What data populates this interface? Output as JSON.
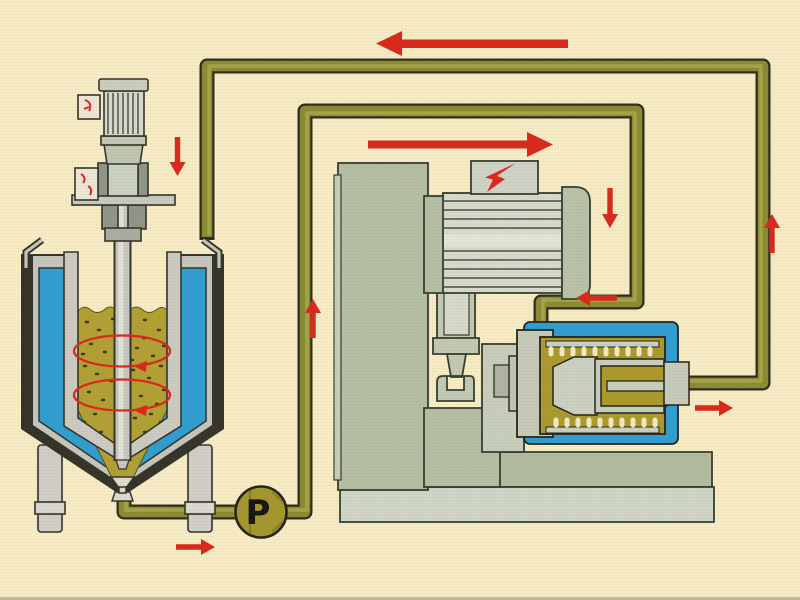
{
  "pump": {
    "label": "P"
  },
  "colors": {
    "background": "#f8edc7",
    "pipe": "#8b8b35",
    "pipe_highlight": "#a9a94e",
    "flow_arrow": "#da291c",
    "coolant_blue": "#2f9fd3",
    "product_olive": "#b1a134",
    "mill_product": "#ab9a2d",
    "pump_body": "#a4972f",
    "machine_green": "#b4bfa5",
    "metal_gray": "#c9cac3"
  },
  "components": {
    "tank": "jacketed-mixing-tank",
    "agitator": "agitator-motor-unit",
    "pump_name": "circulation-pump",
    "mill": "bead-mill-stand",
    "mill_motor": "mill-drive-motor",
    "chamber": "cooled-grinding-chamber",
    "piping": "circulation-piping-loop"
  },
  "flow_arrows": [
    {
      "name": "return-line-arrow",
      "direction": "left"
    },
    {
      "name": "feed-line-arrow",
      "direction": "right"
    },
    {
      "name": "agitator-flow-arrow",
      "direction": "down"
    },
    {
      "name": "pump-riser-arrow",
      "direction": "up"
    },
    {
      "name": "mill-inlet-down-arrow",
      "direction": "down"
    },
    {
      "name": "mill-inlet-arrow",
      "direction": "left"
    },
    {
      "name": "outlet-riser-arrow",
      "direction": "up"
    },
    {
      "name": "mill-outlet-arrow",
      "direction": "right"
    },
    {
      "name": "tank-outlet-arrow",
      "direction": "right"
    },
    {
      "name": "tank-circulation-upper",
      "direction": "circular"
    },
    {
      "name": "tank-circulation-lower",
      "direction": "circular"
    }
  ],
  "symbols": [
    {
      "name": "electric-power-bolt"
    },
    {
      "name": "agitator-indicator-upper"
    },
    {
      "name": "agitator-indicator-lower"
    }
  ]
}
